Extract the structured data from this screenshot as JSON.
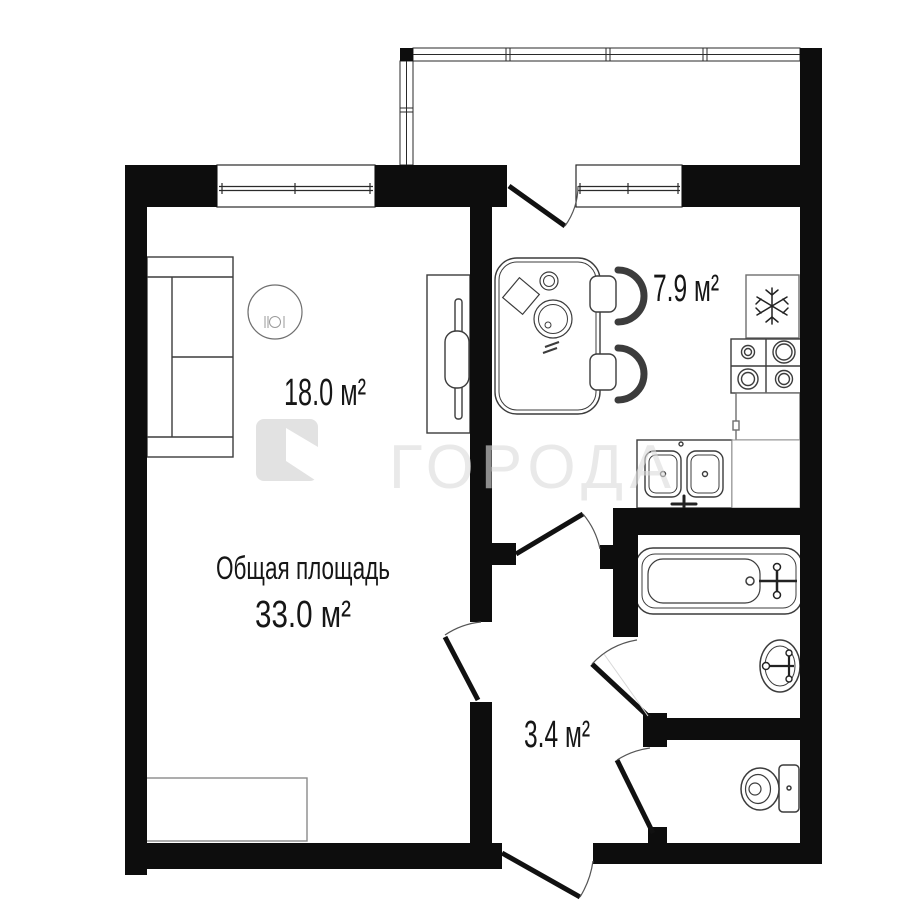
{
  "watermark": {
    "text": "ГОРОДА"
  },
  "labels": {
    "total_caption": "Общая площадь",
    "total_value": "33.0 м²",
    "living_area": "18.0 м²",
    "kitchen_area": "7.9 м²",
    "hallway_area": "3.4 м²"
  },
  "colors": {
    "wall": "#0d0d0d",
    "label_text": "#161616",
    "watermark": "#dcdcdc",
    "furniture_outline": "#3c3c3c",
    "light_outline": "#8a8a8a"
  },
  "icons": {
    "fridge": "snowflake-icon",
    "living_table": "place-setting-icon",
    "watermark_logo": "goroda-logo-icon"
  }
}
